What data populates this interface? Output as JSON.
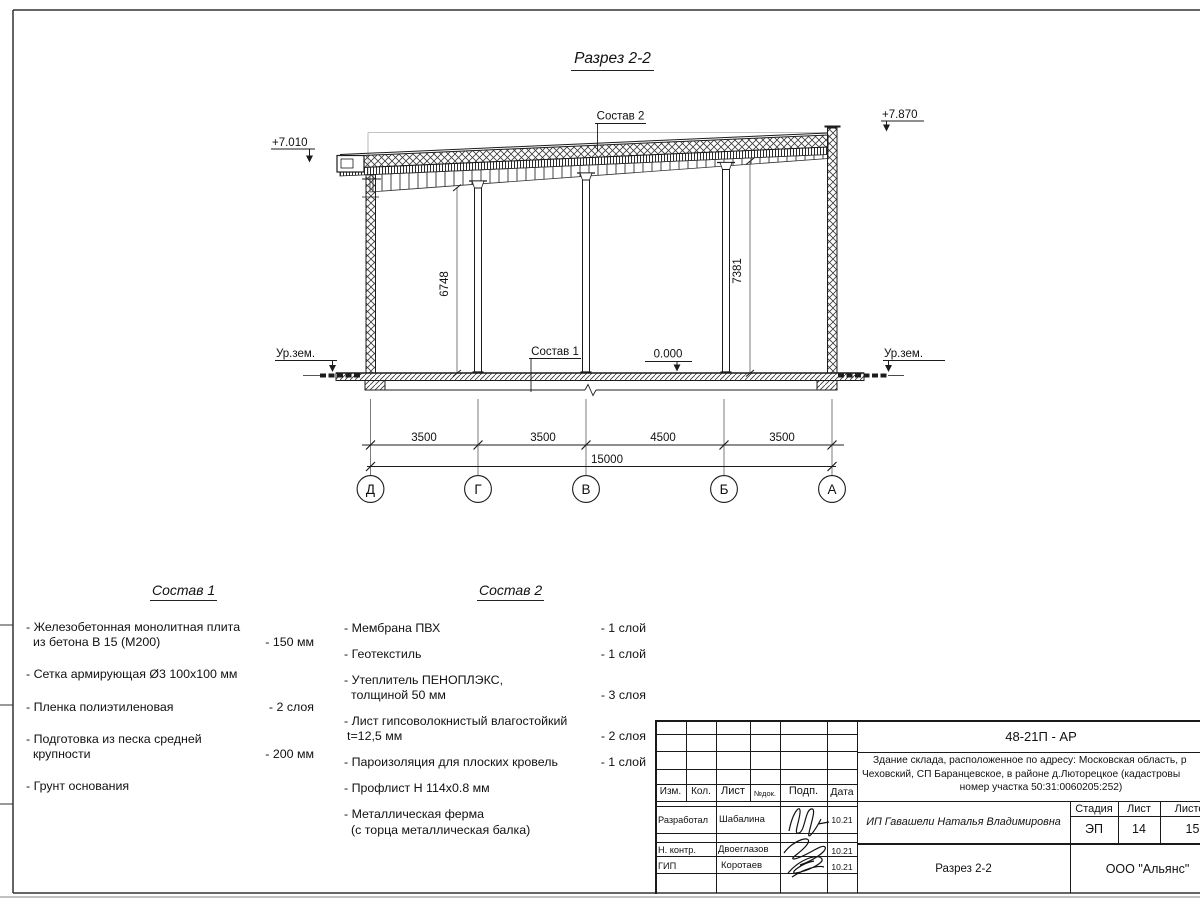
{
  "drawing": {
    "title": "Разрез 2-2",
    "composition1_label": "Состав 1",
    "composition2_label": "Состав 2",
    "elevation_left": "+7.010",
    "elevation_right": "+7.870",
    "elevation_zero": "0.000",
    "ground_left": "Ур.зем.",
    "ground_right": "Ур.зем.",
    "height_dim_left": "6748",
    "height_dim_right": "7381",
    "dim_segments": [
      "3500",
      "3500",
      "4500",
      "3500"
    ],
    "dim_total": "15000",
    "axes": [
      "Д",
      "Г",
      "В",
      "Б",
      "А"
    ]
  },
  "sostav1": {
    "title": "Состав 1",
    "items": [
      {
        "line1": "- Железобетонная  монолитная плита",
        "line2": "из бетона В 15 (М200)",
        "value": "- 150 мм"
      },
      {
        "line1": "- Сетка армирующая Ø3 100х100 мм"
      },
      {
        "line1": "- Пленка полиэтиленовая",
        "value": "-  2 слоя"
      },
      {
        "line1": "- Подготовка из песка средней",
        "line2": "крупности",
        "value": "- 200 мм"
      },
      {
        "line1": "- Грунт основания"
      }
    ]
  },
  "sostav2": {
    "title": "Состав 2",
    "items": [
      {
        "line1": "- Мембрана ПВХ",
        "value": "- 1 слой"
      },
      {
        "line1": "- Геотекстиль",
        "value": "- 1 слой"
      },
      {
        "line1": "- Утеплитель ПЕНОПЛЭКС,",
        "line2": "толщиной 50 мм",
        "value": "- 3 слоя"
      },
      {
        "line1": "- Лист гипсоволокнистый влагостойкий",
        "line2": "t=12,5 мм",
        "value": "- 2 слоя"
      },
      {
        "line1": "- Пароизоляция для плоских кровель",
        "value": "- 1 слой"
      },
      {
        "line1": "- Профлист Н 114х0.8 мм"
      },
      {
        "line1": "- Металлическая ферма",
        "line2": "(с торца металлическая балка)"
      }
    ]
  },
  "titleblock": {
    "doc_number": "48-21П - АР",
    "description_line1": "Здание склада, расположенное по адресу: Московская область, р",
    "description_line2": "Чеховский, СП Баранцевское, в районе д.Люторецкое  (кадастровы",
    "description_line3": "номер участка 50:31:0060205:252)",
    "columns": {
      "izm": "Изм.",
      "kol": "Кол.",
      "list": "Лист",
      "ndok": "№док.",
      "podp": "Подп.",
      "data": "Дата"
    },
    "rows": [
      {
        "role": "Разработал",
        "name": "Шабалина",
        "date": "10.21"
      },
      {
        "role": "Н. контр.",
        "name": "Двоеглазов",
        "date": "10.21"
      },
      {
        "role": "ГИП",
        "name": "Коротаев",
        "date": "10.21"
      }
    ],
    "client": "ИП Гавашели Наталья Владимировна",
    "stage_label": "Стадия",
    "sheet_label": "Лист",
    "sheets_label": "Листов",
    "stage": "ЭП",
    "sheet": "14",
    "sheets": "15",
    "section_name": "Разрез 2-2",
    "company": "ООО \"Альянс\""
  }
}
